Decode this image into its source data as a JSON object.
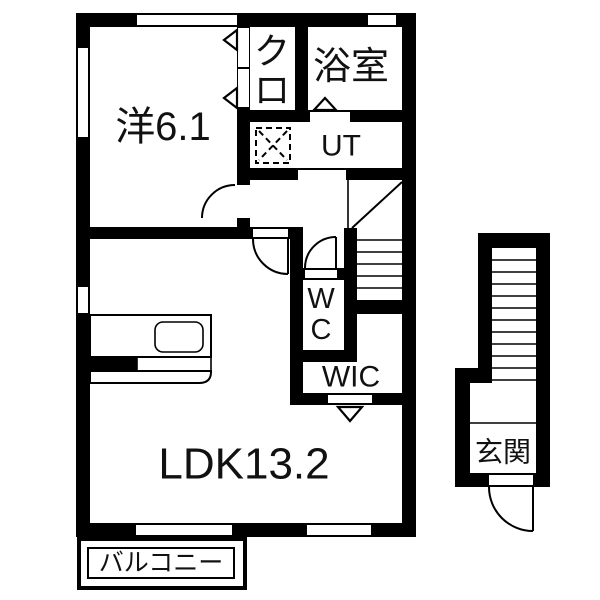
{
  "rooms": {
    "western": {
      "label": "洋6.1"
    },
    "closet": {
      "chars": [
        "ク",
        "ロ"
      ]
    },
    "bath": {
      "label": "浴室"
    },
    "utility": {
      "label": "UT"
    },
    "wc": {
      "chars": [
        "W",
        "C"
      ]
    },
    "wic": {
      "label": "WIC"
    },
    "ldk": {
      "label": "LDK13.2"
    },
    "balcony": {
      "label": "バルコニー"
    },
    "entrance": {
      "label": "玄関"
    }
  },
  "colors": {
    "wall": "#000000",
    "floor": "#ffffff",
    "text": "#111111"
  }
}
